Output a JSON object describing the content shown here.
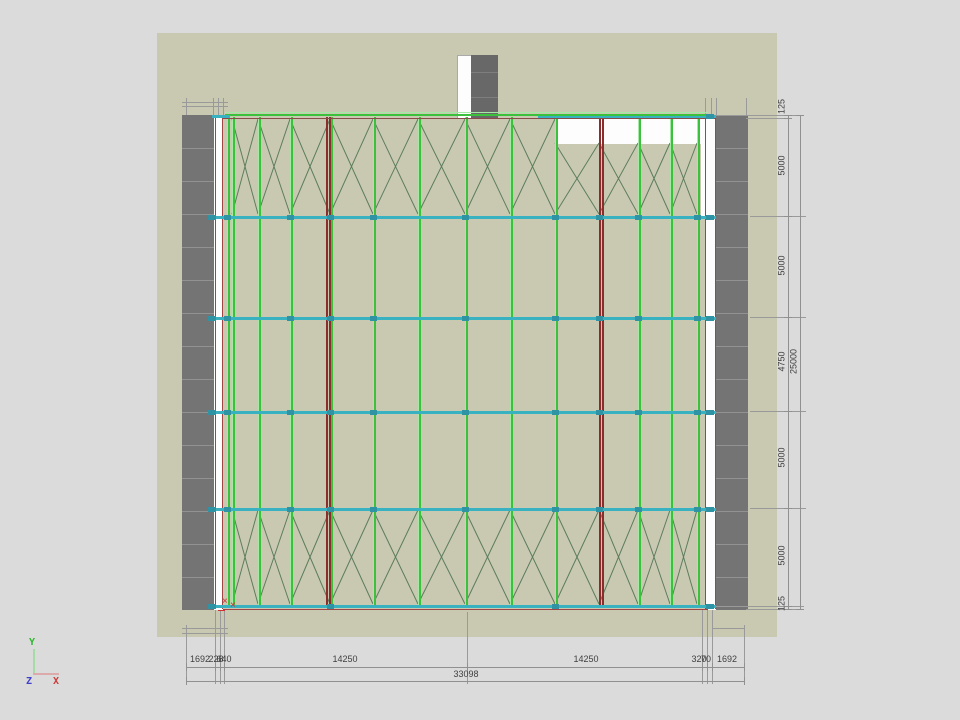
{
  "view": {
    "name": "structural-plan-view"
  },
  "dimensions": {
    "right": {
      "segments": [
        "125",
        "5000",
        "5000",
        "4750",
        "5000",
        "5000",
        "125"
      ],
      "total": "25000"
    },
    "bottom": {
      "segments": [
        "1692",
        "228",
        "640",
        "14250",
        "14250",
        "320",
        "70",
        "1692"
      ],
      "total": "33098"
    }
  },
  "axis_triad": {
    "x_label": "X",
    "y_label": "Y",
    "z_label": "Z"
  },
  "origin_marker": {
    "glyph": "×"
  },
  "colors": {
    "background": "#dbdbdb",
    "slab": "#c9c9b2",
    "wall": "#747474",
    "wall_seam": "#8a8a8a",
    "white": "#fdfdfd",
    "core_gray": "#686868",
    "member_green": "#3cc13c",
    "member_green_light": "#a7e8a7",
    "brace_green": "#5c7d5c",
    "beam_cyan": "#38b2c0",
    "beam_cyan_dark": "#2f93a3",
    "column_red": "#8b2d2d",
    "edge_red": "#a04545",
    "origin_red": "#d03030",
    "dim_line": "#909090",
    "dim_text": "#3f3f3f",
    "axis_y": "#2db82d",
    "axis_x": "#cc3a3a",
    "axis_z": "#4040cc"
  }
}
